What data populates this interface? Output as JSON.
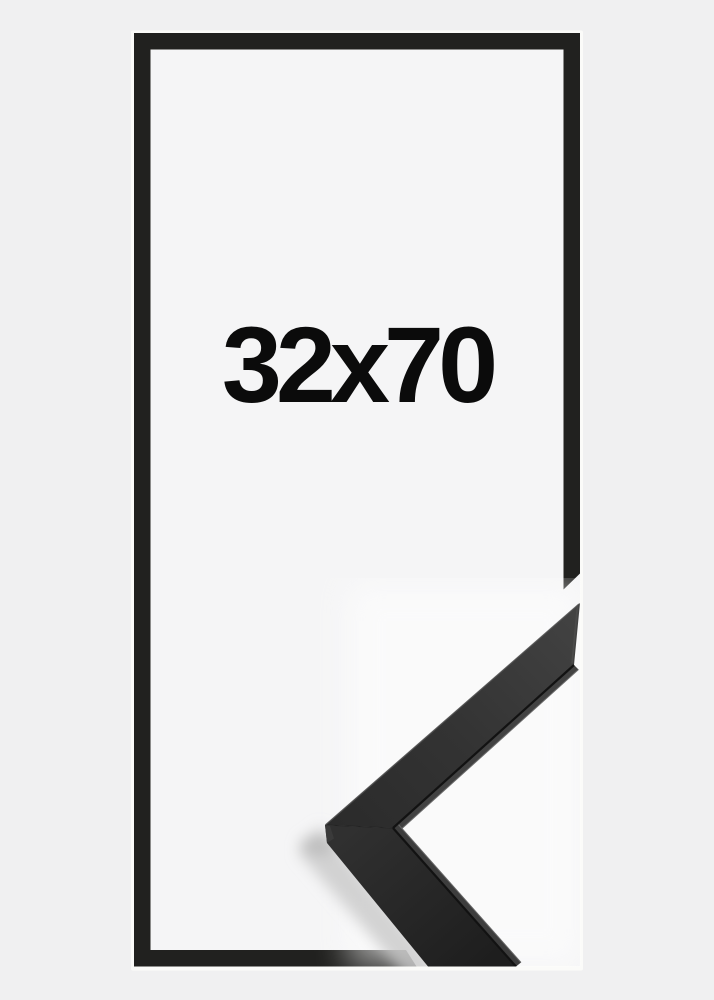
{
  "product_image": {
    "size_label": "32x70",
    "subject": "picture-frame-black"
  },
  "colors": {
    "background": "#f0f0f1",
    "canvas": "#f5f5f6",
    "halo": "#fbfbf9",
    "frame": "#21211f",
    "text": "#0b0b0b",
    "moulding_face_light": "#424242",
    "moulding_face_dark": "#1e1e1e",
    "moulding_lip_upper": "#424242",
    "moulding_lip_lower": "#3d3d3d",
    "shadow": "#c8c8c8"
  }
}
